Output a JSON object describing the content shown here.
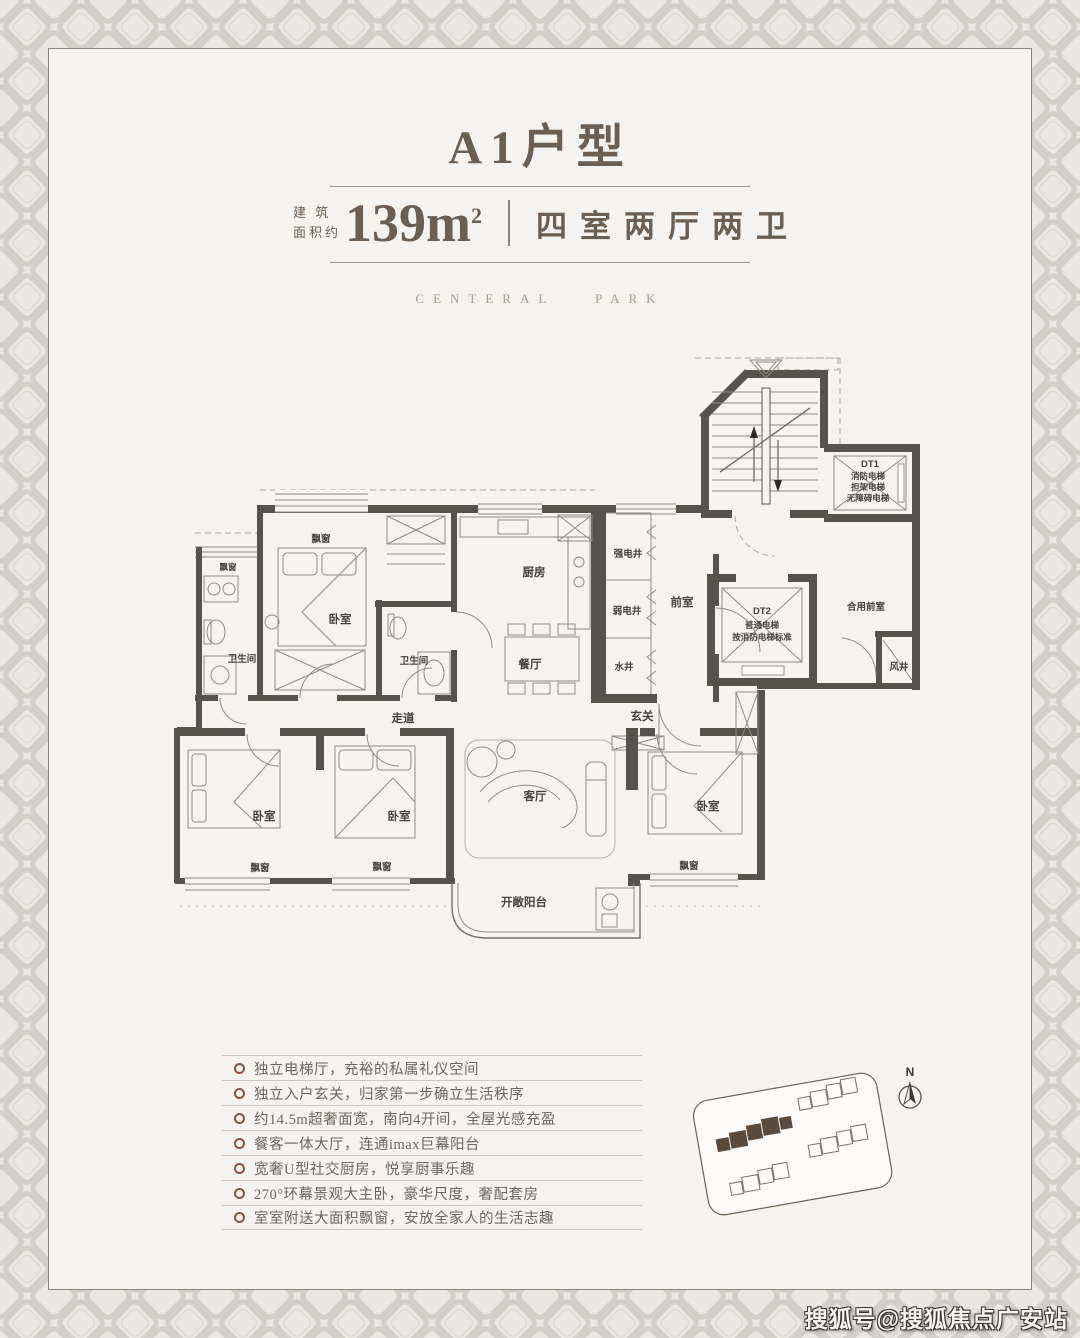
{
  "header": {
    "title": "A1户型",
    "area_label_top": "建 筑",
    "area_label_bottom": "面积约",
    "area_value": "139m",
    "area_sup": "2",
    "layout": "四室两厅两卫",
    "brand": "CENTERAL PARK"
  },
  "floorplan": {
    "labels": {
      "bay_bath_left": "飘窗",
      "bay_top": "飘窗",
      "bedroom_top": "卧室",
      "bath_left": "卫生间",
      "bath_mid": "卫生间",
      "kitchen": "厨房",
      "dining": "餐厅",
      "shaft_strong": "强电井",
      "shaft_weak": "弱电井",
      "shaft_water": "水井",
      "front_room": "前室",
      "corridor": "走道",
      "foyer": "玄关",
      "living": "客厅",
      "bedroom_bl": "卧室",
      "bedroom_bm": "卧室",
      "bedroom_br": "卧室",
      "bay_bl": "飘窗",
      "bay_bm": "飘窗",
      "bay_br": "飘窗",
      "balcony": "开敞阳台",
      "shared_front": "合用前室",
      "wind_shaft": "风井",
      "dt1_title": "DT1",
      "dt1_line1": "消防电梯",
      "dt1_line2": "担架电梯",
      "dt1_line3": "无障碍电梯",
      "dt2_title": "DT2",
      "dt2_line1": "普通电梯",
      "dt2_line2": "按消防电梯标准"
    }
  },
  "features": {
    "items": [
      "独立电梯厅，充裕的私属礼仪空间",
      "独立入户玄关，归家第一步确立生活秩序",
      "约14.5m超奢面宽，南向4开间，全屋光感充盈",
      "餐客一体大厅，连通imax巨幕阳台",
      "宽奢U型社交厨房，悦享厨事乐趣",
      "270°环幕景观大主卧，豪华尺度，奢配套房",
      "室室附送大面积飘窗，安放全家人的生活志趣"
    ]
  },
  "siteplan": {
    "north": "N"
  },
  "watermark": "搜狐号@搜狐焦点广安站",
  "colors": {
    "accent": "#6b5e52",
    "bullet_ring": "#8a5240",
    "wall": "#56524d",
    "highlight_building": "#5a4b3f",
    "panel_bg": "#f4f3f0",
    "border_bg": "#e9e7e4"
  }
}
